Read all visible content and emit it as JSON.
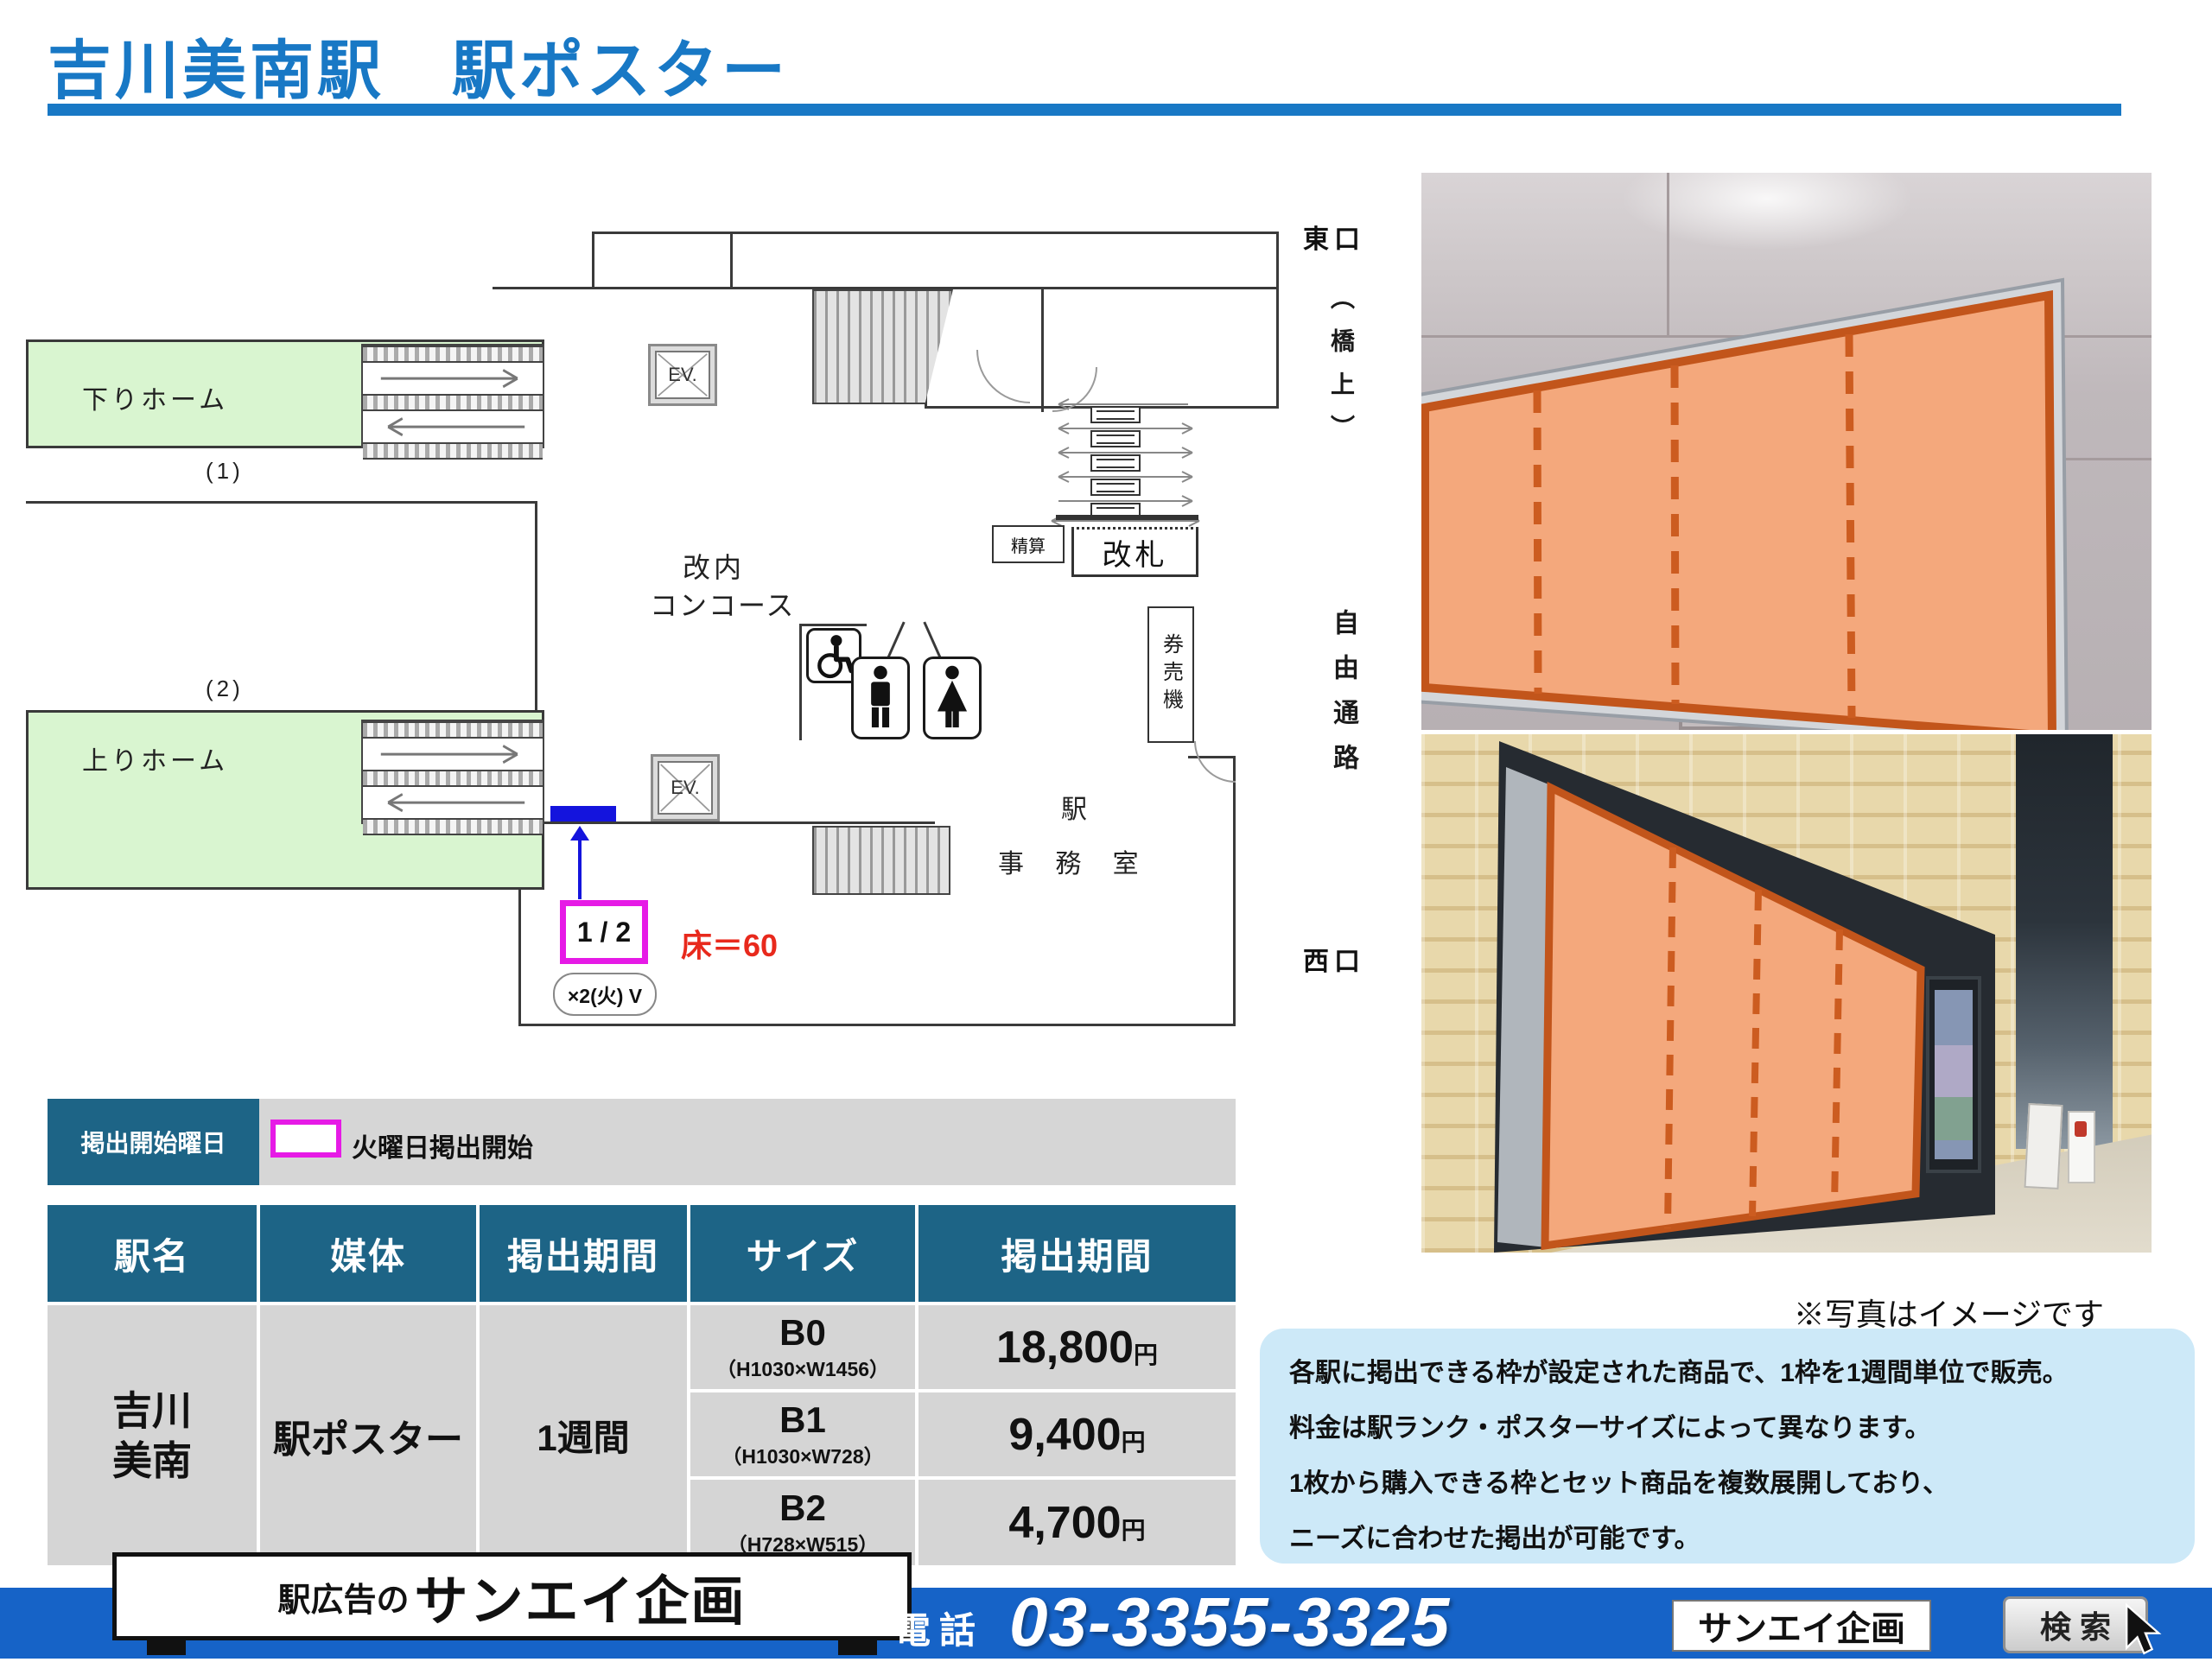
{
  "page_title": "吉川美南駅　駅ポスター",
  "plan": {
    "platform_down_label": "下りホーム",
    "platform_up_label": "上りホーム",
    "track1_label": "(1)",
    "track2_label": "(2)",
    "concourse_line1": "改内",
    "concourse_line2": "コンコース",
    "elevator_label": "EV.",
    "gate_label": "改札",
    "fare_adjust_label": "精算",
    "ticket_machine_label": "券売機",
    "office_line1": "駅",
    "office_line2": "事 務 室",
    "slot_label": "1 / 2",
    "slot_count_note": "×2(火) V",
    "floor_note": "床＝60"
  },
  "directions": {
    "east": "東口",
    "bridge": "（橋上）",
    "passage": "自由通路",
    "west": "西口"
  },
  "photos": {
    "caption": "※写真はイメージです"
  },
  "schedule_banner": {
    "label": "掲出開始曜日",
    "note": "火曜日掲出開始"
  },
  "table": {
    "headers": [
      "駅名",
      "媒体",
      "掲出期間",
      "サイズ",
      "掲出期間"
    ],
    "station_line1": "吉川",
    "station_line2": "美南",
    "media": "駅ポスター",
    "period": "1週間",
    "rows": [
      {
        "size": "B0",
        "dims": "（H1030×W1456）",
        "price": "18,800",
        "unit": "円"
      },
      {
        "size": "B1",
        "dims": "（H1030×W728）",
        "price": "9,400",
        "unit": "円"
      },
      {
        "size": "B2",
        "dims": "（H728×W515）",
        "price": "4,700",
        "unit": "円"
      }
    ]
  },
  "info_box": {
    "lines": [
      "各駅に掲出できる枠が設定された商品で、1枠を1週間単位で販売。",
      "料金は駅ランク・ポスターサイズによって異なります。",
      "1枚から購入できる枠とセット商品を複数展開しており、",
      "ニーズに合わせた掲出が可能です。"
    ]
  },
  "footer": {
    "sign_prefix": "駅広告の",
    "sign_name": "サンエイ企画",
    "tel_label": "電話",
    "tel_number": "03-3355-3325",
    "search_value": "サンエイ企画",
    "search_button": "検 索"
  },
  "colors": {
    "accent_blue": "#1878c5",
    "teal": "#1d6486",
    "magenta": "#e61ae6",
    "marker_blue": "#1414dd",
    "note_red": "#e8291c",
    "platform_green": "#d9f5d0",
    "highlight_orange": "#f4a87c",
    "footer_blue": "#1663c7",
    "info_bg": "#cde9f8"
  }
}
